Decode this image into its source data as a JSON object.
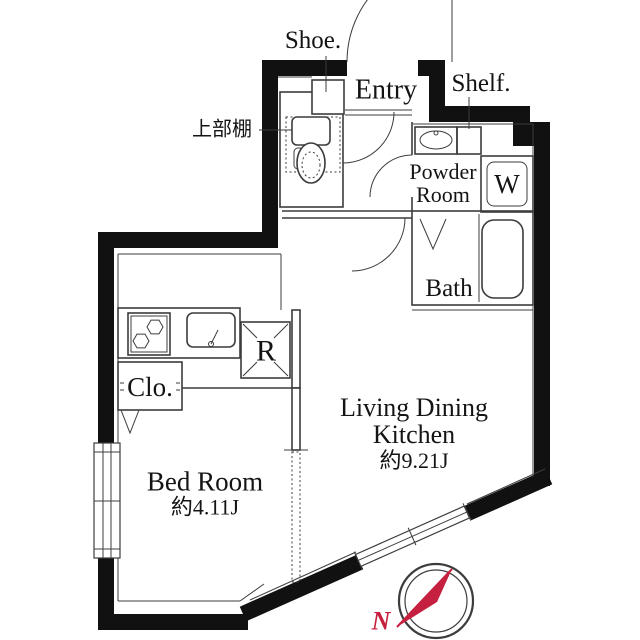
{
  "rooms": {
    "entry": {
      "label": "Entry"
    },
    "powder_room": {
      "label_line1": "Powder",
      "label_line2": "Room"
    },
    "bath": {
      "label": "Bath"
    },
    "ldk": {
      "label_line1": "Living Dining",
      "label_line2": "Kitchen",
      "area": "約9.21J"
    },
    "bedroom": {
      "label": "Bed Room",
      "area": "約4.11J"
    }
  },
  "fixtures": {
    "shoe_cabinet": "Shoe.",
    "shelf": "Shelf.",
    "upper_shelf": "上部棚",
    "washing_machine": "W",
    "refrigerator": "R",
    "closet": "Clo."
  },
  "compass": {
    "north": "N"
  },
  "colors": {
    "wall": "#111111",
    "thin_line": "#3c3c3c",
    "compass_needle": "#c5203f",
    "background": "#ffffff"
  }
}
